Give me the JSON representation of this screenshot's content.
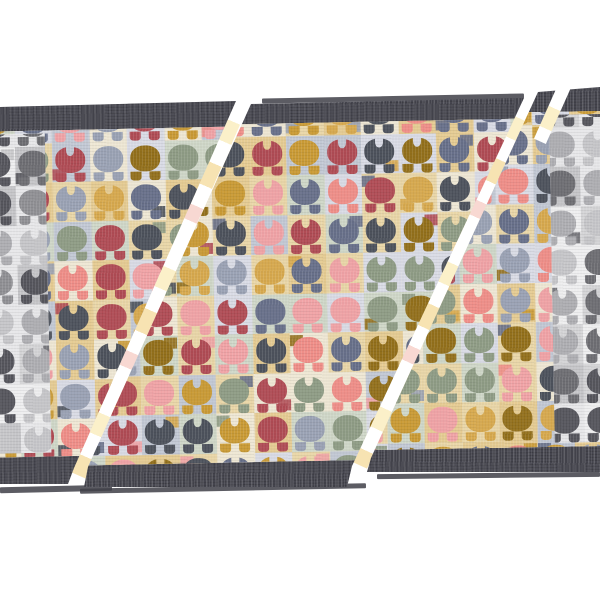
{
  "image": {
    "alt": "Product photo: overlapping fanned doormats with a retro heart and dot pattern, charcoal grey binding borders, shown on a plain white background; a grey colourway mat peeks out at the far left and right edges.",
    "background": "#ffffff"
  },
  "mat": {
    "border_color": "#46464f",
    "base_color": "#e7decb",
    "seed": 13,
    "palette": {
      "backgrounds": [
        "#eee7d4",
        "#e9d6a7",
        "#d9dbe5",
        "#cfd7c8",
        "#c2c8d4",
        "#e5cb92"
      ],
      "blobs": [
        "#ef8e88",
        "#b04c55",
        "#f0a3a6",
        "#c99a35",
        "#93701c",
        "#68708a",
        "#9aa2b4",
        "#8f9c85",
        "#4d525c",
        "#d7a94e"
      ]
    },
    "gray_palette": {
      "backgrounds": [
        "#e7e7e9",
        "#d4d4d6",
        "#c5c5c8",
        "#eeeeef"
      ],
      "blobs": [
        "#909094",
        "#6e6e73",
        "#aeaeb2",
        "#56565d",
        "#c6c6c9"
      ]
    },
    "gap_blotch_colors": [
      "#ffffff",
      "#fbf0c9",
      "#f7e3b2",
      "#f8d8d2"
    ],
    "edge_line_color": "#3f3f48"
  }
}
